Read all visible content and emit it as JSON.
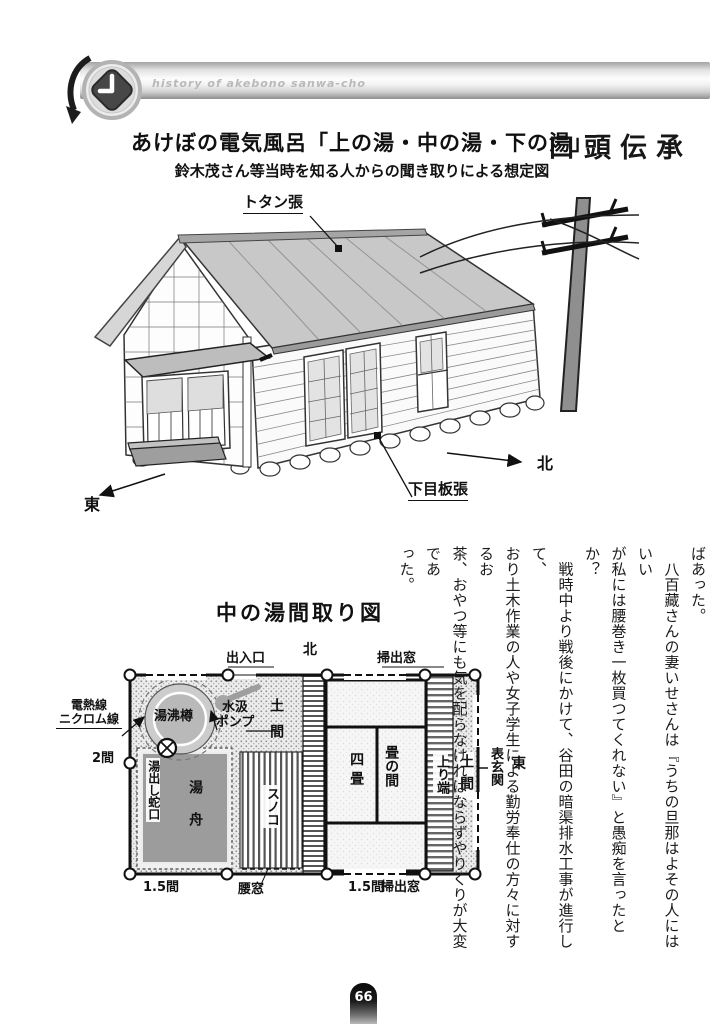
{
  "header": {
    "small_title": "history of akebono sanwa-cho",
    "section_title": "口頭伝承"
  },
  "title": {
    "main": "あけぼの電気風呂「上の湯・中の湯・下の湯」",
    "sub": "鈴木茂さん等当時を知る人からの聞き取りによる想定図"
  },
  "house": {
    "roof_label": "トタン張",
    "siding_label": "下目板張",
    "north": "北",
    "east": "東"
  },
  "plan": {
    "title": "中の湯間取り図",
    "north": "北",
    "east": "東",
    "entrance": "出入口",
    "sweep_window_top": "掃出窓",
    "sweep_window_bottom": "掃出窓",
    "heater_l1": "電熱線",
    "heater_l2": "ニクロム線",
    "boiler": "湯沸樽",
    "pump_l1": "水汲",
    "pump_l2": "ポンプ",
    "doma_left": "土間",
    "doma_right": "土間",
    "dim_left": "2間",
    "tap": "湯出し蛇口",
    "tub": "湯舟",
    "duckboard": "スノコ",
    "four_tatami": "四畳",
    "tatami_room": "畳の間",
    "agari_hana": "上り端",
    "front_entrance": "表玄関",
    "dim_bottom_left": "1.5間",
    "waist_window": "腰窓",
    "dim_bottom_right": "1.5間"
  },
  "body": {
    "lines": [
      "ばあった。",
      "　八百藏さんの妻いせさんは『うちの旦那はよその人にはいい",
      "が私には腰巻き一枚買つてくれない』と愚痴を言ったとか？",
      "　戦時中より戦後にかけて、谷田の暗渠排水工事が進行して、",
      "おり土木作業の人や女子学生による勤労奉仕の方々に対するお",
      "茶、おやつ等にも気を配らなければならずやりくりが大変であ",
      "った。"
    ]
  },
  "page": {
    "number": "66"
  }
}
